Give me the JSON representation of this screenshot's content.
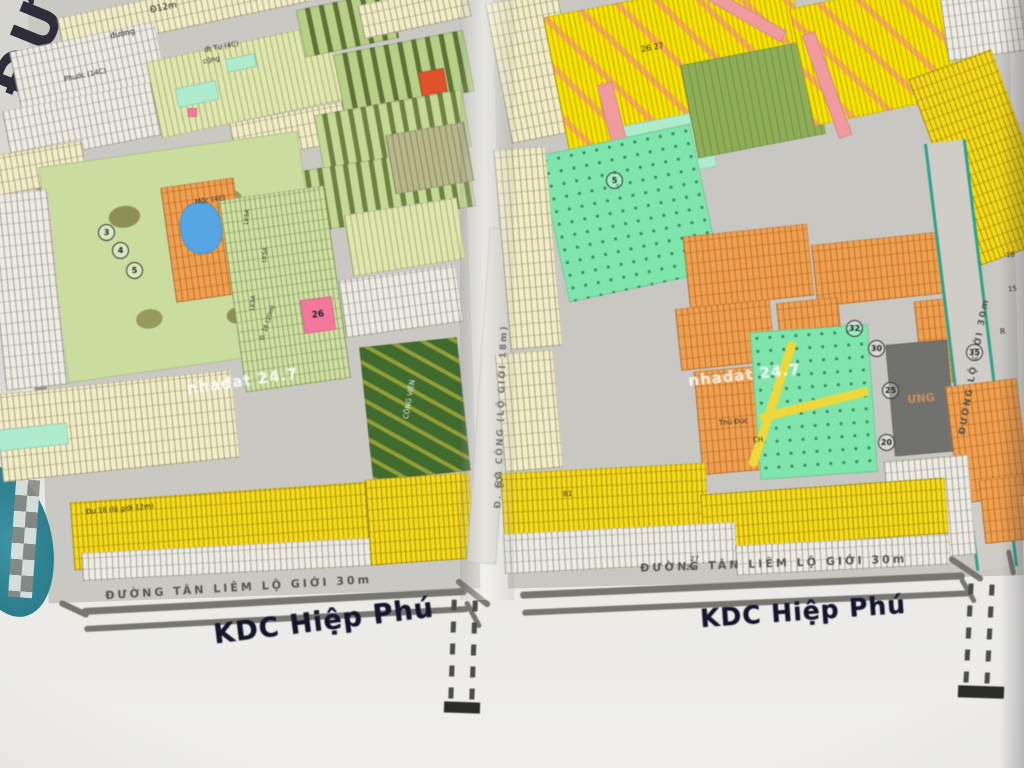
{
  "map": {
    "corner_text": "ĐƯ",
    "watermark_text": "nhadat 24.7",
    "watermarks": [
      {
        "x": 186,
        "y": 372,
        "rot": -8
      },
      {
        "x": 688,
        "y": 366,
        "rot": -6
      }
    ],
    "titles": [
      {
        "t": "KDC Hiệp Phú",
        "x": 213,
        "y": 606,
        "rot": -7,
        "s": 27
      },
      {
        "t": "KDC Hiệp Phú",
        "x": 700,
        "y": 597,
        "rot": -4,
        "s": 25
      }
    ],
    "road_names": [
      {
        "t": "ĐƯỜNG TÂN LIÊM LỘ GIỚI 30m",
        "x": 105,
        "y": 582,
        "rot": -3.5,
        "s": 11,
        "sp": 3
      },
      {
        "t": "ĐƯỜNG TÂN LIÊM LỘ GIỚI 30m",
        "x": 640,
        "y": 558,
        "rot": -2,
        "s": 11,
        "sp": 3
      },
      {
        "t": "Đ. GÒ CÔNG (LỘ GIỚI 18m)",
        "x": 352,
        "y": 412,
        "rot": -88,
        "s": 9,
        "sp": 2,
        "w": 300
      },
      {
        "t": "ĐƯỜNG LỘ GIỚI 30m",
        "x": 845,
        "y": 362,
        "rot": -80,
        "s": 9,
        "sp": 2,
        "w": 260
      }
    ],
    "labels": [
      {
        "t": "Đ12m",
        "x": 150,
        "y": 4,
        "rot": -12,
        "s": 9
      },
      {
        "t": "đường",
        "x": 110,
        "y": 30,
        "rot": -12,
        "s": 8
      },
      {
        "t": "đt Tư (4C)",
        "x": 204,
        "y": 44,
        "rot": -11,
        "s": 7
      },
      {
        "t": "cộng",
        "x": 203,
        "y": 57,
        "rot": -11,
        "s": 7
      },
      {
        "t": "Phước (14C)",
        "x": 64,
        "y": 72,
        "rot": -12,
        "s": 7
      },
      {
        "t": "Mộc (4E)",
        "x": 195,
        "y": 197,
        "rot": -8,
        "s": 7
      },
      {
        "t": "LK5A",
        "x": 240,
        "y": 214,
        "rot": -85,
        "s": 6
      },
      {
        "t": "LK5A",
        "x": 258,
        "y": 252,
        "rot": -85,
        "s": 6
      },
      {
        "t": "LK5A",
        "x": 246,
        "y": 300,
        "rot": -85,
        "s": 6
      },
      {
        "t": "Đ. 16 (20m)",
        "x": 250,
        "y": 320,
        "rot": -72,
        "s": 6
      },
      {
        "t": "Đư 18 (lộ giới 12m)",
        "x": 86,
        "y": 506,
        "rot": -5,
        "s": 7
      },
      {
        "t": "CÔNG VIÊN",
        "x": 390,
        "y": 396,
        "rot": -80,
        "s": 7,
        "cls": "w"
      },
      {
        "t": "26 27",
        "x": 641,
        "y": 44,
        "rot": -11,
        "s": 8
      },
      {
        "t": "Thủ Đức",
        "x": 719,
        "y": 419,
        "rot": -5,
        "s": 7
      },
      {
        "t": "CH",
        "x": 753,
        "y": 437,
        "rot": -5,
        "s": 7
      },
      {
        "t": "202",
        "x": 489,
        "y": 476,
        "rot": 80,
        "s": 9
      },
      {
        "t": "27",
        "x": 690,
        "y": 556,
        "rot": 0,
        "s": 7
      },
      {
        "t": "28",
        "x": 686,
        "y": 565,
        "rot": 0,
        "s": 7
      },
      {
        "t": "B1",
        "x": 563,
        "y": 491,
        "rot": -3,
        "s": 7
      },
      {
        "t": "R",
        "x": 1000,
        "y": 328,
        "rot": -7,
        "s": 8
      },
      {
        "t": "18",
        "x": 1006,
        "y": 252,
        "rot": -7,
        "s": 7
      },
      {
        "t": "15",
        "x": 1008,
        "y": 286,
        "rot": -7,
        "s": 7
      }
    ],
    "circles": [
      {
        "n": "3",
        "x": 98,
        "y": 224
      },
      {
        "n": "4",
        "x": 112,
        "y": 242
      },
      {
        "n": "5",
        "x": 126,
        "y": 262
      },
      {
        "n": "5",
        "x": 606,
        "y": 172
      },
      {
        "n": "32",
        "x": 846,
        "y": 320
      },
      {
        "n": "30",
        "x": 868,
        "y": 340
      },
      {
        "n": "25",
        "x": 882,
        "y": 382
      },
      {
        "n": "20",
        "x": 878,
        "y": 434
      },
      {
        "n": "35",
        "x": 966,
        "y": 344
      }
    ],
    "blocks": [
      {
        "n": "parcel-row",
        "cls": "cream-row",
        "x": 58,
        "y": -8,
        "w": 250,
        "h": 36,
        "rot": -12
      },
      {
        "n": "parcel-row",
        "cls": "white-row",
        "x": 14,
        "y": 36,
        "w": 148,
        "h": 62,
        "rot": -12
      },
      {
        "n": "parcel-row",
        "cls": "white-row",
        "x": 6,
        "y": 96,
        "w": 152,
        "h": 54,
        "rot": -11
      },
      {
        "n": "parcel-row",
        "cls": "cream-row",
        "x": -6,
        "y": 148,
        "w": 92,
        "h": 40,
        "rot": -10
      },
      {
        "n": "parcel-row",
        "cls": "green-pale",
        "x": 152,
        "y": 42,
        "w": 185,
        "h": 78,
        "rot": -12
      },
      {
        "n": "parcel-patch",
        "cls": "mint",
        "x": 176,
        "y": 84,
        "w": 42,
        "h": 20,
        "rot": -12
      },
      {
        "n": "parcel-patch",
        "cls": "mint",
        "x": 226,
        "y": 56,
        "w": 30,
        "h": 14,
        "rot": -12
      },
      {
        "n": "parcel-patch",
        "cls": "pink-block",
        "x": 188,
        "y": 108,
        "w": 9,
        "h": 9,
        "rot": 0
      },
      {
        "n": "parcel-row",
        "cls": "cream-row",
        "x": 232,
        "y": 112,
        "w": 115,
        "h": 40,
        "rot": -11
      },
      {
        "n": "city-block",
        "cls": "dark-city",
        "x": 300,
        "y": 0,
        "w": 95,
        "h": 48,
        "rot": -12
      },
      {
        "n": "city-block",
        "cls": "dark-city",
        "x": 338,
        "y": 42,
        "w": 132,
        "h": 62,
        "rot": -11
      },
      {
        "n": "city-block",
        "cls": "dark-city2",
        "x": 318,
        "y": 102,
        "w": 150,
        "h": 58,
        "rot": -10
      },
      {
        "n": "city-block",
        "cls": "dark-city2",
        "x": 300,
        "y": 158,
        "w": 172,
        "h": 62,
        "rot": -9
      },
      {
        "n": "building-marker",
        "cls": "red-marker",
        "x": 420,
        "y": 70,
        "w": 26,
        "h": 24,
        "rot": -10
      },
      {
        "n": "parcel-row",
        "cls": "cream-row",
        "x": 360,
        "y": -6,
        "w": 110,
        "h": 34,
        "rot": -12
      },
      {
        "n": "park-area",
        "cls": "park",
        "x": 52,
        "y": 148,
        "w": 262,
        "h": 218,
        "rot": -8
      },
      {
        "n": "parcel-row",
        "cls": "orange-row",
        "x": 168,
        "y": 182,
        "w": 74,
        "h": 116,
        "rot": -8
      },
      {
        "n": "pond",
        "cls": "blue-pond",
        "x": 180,
        "y": 202,
        "w": 42,
        "h": 52,
        "rot": -8
      },
      {
        "n": "parcel-row",
        "cls": "green-row",
        "x": 232,
        "y": 192,
        "w": 106,
        "h": 194,
        "rot": -8
      },
      {
        "n": "parcel-row",
        "cls": "white-row",
        "x": -4,
        "y": 192,
        "w": 62,
        "h": 196,
        "rot": -6
      },
      {
        "n": "parcel-row",
        "cls": "cream-row",
        "x": -2,
        "y": 382,
        "w": 238,
        "h": 88,
        "rot": -6
      },
      {
        "n": "parcel-patch",
        "cls": "mint",
        "x": -2,
        "y": 426,
        "w": 70,
        "h": 22,
        "rot": -6
      },
      {
        "n": "parcel-row",
        "cls": "yellow-row",
        "x": 72,
        "y": 492,
        "w": 296,
        "h": 68,
        "rot": -4
      },
      {
        "n": "parcel-row",
        "cls": "white-row",
        "x": 82,
        "y": 545,
        "w": 305,
        "h": 28,
        "rot": -3
      },
      {
        "n": "parcel-block",
        "cls": "pink-block",
        "x": 302,
        "y": 298,
        "w": 32,
        "h": 34,
        "rot": -8,
        "label": "26"
      },
      {
        "n": "parcel-row",
        "cls": "green-pale",
        "x": 348,
        "y": 206,
        "w": 114,
        "h": 62,
        "rot": -9
      },
      {
        "n": "parcel-row",
        "cls": "white-row",
        "x": 342,
        "y": 272,
        "w": 118,
        "h": 58,
        "rot": -8
      },
      {
        "n": "park-area",
        "cls": "forest",
        "x": 366,
        "y": 342,
        "w": 98,
        "h": 134,
        "rot": -6
      },
      {
        "n": "parcel-row",
        "cls": "yellow-row",
        "x": 368,
        "y": 476,
        "w": 104,
        "h": 86,
        "rot": -4
      },
      {
        "n": "parcel-row",
        "cls": "khaki-row",
        "x": 390,
        "y": 128,
        "w": 80,
        "h": 60,
        "rot": -10
      },
      {
        "n": "road-strip",
        "cls": "road-v",
        "x": 478,
        "y": 228,
        "w": 30,
        "h": 336,
        "rot": 4
      },
      {
        "n": "parcel-row",
        "cls": "cream-row",
        "x": 498,
        "y": -4,
        "w": 74,
        "h": 142,
        "rot": -11
      },
      {
        "n": "parcel-row",
        "cls": "yellow-dense",
        "x": 556,
        "y": -8,
        "w": 250,
        "h": 160,
        "rot": -11
      },
      {
        "n": "parcel-patch",
        "cls": "mint",
        "x": 618,
        "y": 118,
        "w": 95,
        "h": 58,
        "rot": -11
      },
      {
        "n": "city-block",
        "cls": "green-mid",
        "x": 688,
        "y": 52,
        "w": 130,
        "h": 95,
        "rot": -11
      },
      {
        "n": "road-strip",
        "cls": "salmon",
        "x": 608,
        "y": 82,
        "w": 16,
        "h": 95,
        "rot": -14
      },
      {
        "n": "road-strip",
        "cls": "salmon",
        "x": 700,
        "y": 8,
        "w": 90,
        "h": 13,
        "rot": 30
      },
      {
        "n": "parcel-row",
        "cls": "yellow-dense",
        "x": 800,
        "y": -8,
        "w": 150,
        "h": 120,
        "rot": -12
      },
      {
        "n": "road-strip",
        "cls": "salmon",
        "x": 820,
        "y": 30,
        "w": 14,
        "h": 110,
        "rot": -20
      },
      {
        "n": "parcel-row",
        "cls": "white-row",
        "x": 944,
        "y": -6,
        "w": 80,
        "h": 62,
        "rot": -8
      },
      {
        "n": "parcel-row",
        "cls": "yellow-row",
        "x": 940,
        "y": 58,
        "w": 88,
        "h": 200,
        "rot": -20
      },
      {
        "n": "park-area",
        "cls": "mint-bright",
        "x": 552,
        "y": 138,
        "w": 155,
        "h": 150,
        "rot": -12
      },
      {
        "n": "marker",
        "cls": "teal",
        "x": 512,
        "y": 204,
        "w": 20,
        "h": 20,
        "rot": 0
      },
      {
        "n": "parcel-row",
        "cls": "cream-row",
        "x": 502,
        "y": 148,
        "w": 52,
        "h": 200,
        "rot": -5
      },
      {
        "n": "parcel-row",
        "cls": "orange-row",
        "x": 686,
        "y": 230,
        "w": 125,
        "h": 72,
        "rot": -6
      },
      {
        "n": "parcel-row",
        "cls": "orange-row",
        "x": 814,
        "y": 238,
        "w": 132,
        "h": 62,
        "rot": -6
      },
      {
        "n": "parcel-row",
        "cls": "orange-row",
        "x": 678,
        "y": 304,
        "w": 95,
        "h": 62,
        "rot": -6
      },
      {
        "n": "parcel-row",
        "cls": "orange-row",
        "x": 698,
        "y": 368,
        "w": 76,
        "h": 104,
        "rot": -5
      },
      {
        "n": "parcel-row",
        "cls": "orange-row",
        "x": 778,
        "y": 300,
        "w": 62,
        "h": 40,
        "rot": -6
      },
      {
        "n": "parcel-row",
        "cls": "orange-row",
        "x": 918,
        "y": 298,
        "w": 62,
        "h": 84,
        "rot": -6
      },
      {
        "n": "park-area",
        "cls": "mint-bright",
        "x": 755,
        "y": 328,
        "w": 118,
        "h": 148,
        "rot": -4
      },
      {
        "n": "path",
        "cls": "yellow-path",
        "x": 768,
        "y": 338,
        "w": 9,
        "h": 132,
        "rot": 18
      },
      {
        "n": "path",
        "cls": "yellow-path",
        "x": 758,
        "y": 400,
        "w": 112,
        "h": 9,
        "rot": -14
      },
      {
        "n": "city-block",
        "cls": "darkgray",
        "x": 890,
        "y": 342,
        "w": 62,
        "h": 112,
        "rot": -5,
        "label": "ƯNG"
      },
      {
        "n": "road-strip",
        "cls": "road-diag",
        "x": 950,
        "y": 140,
        "w": 36,
        "h": 430,
        "rot": -7
      },
      {
        "n": "parcel-row",
        "cls": "orange-row",
        "x": 952,
        "y": 382,
        "w": 72,
        "h": 118,
        "rot": -7
      },
      {
        "n": "parcel-row",
        "cls": "white-row",
        "x": 888,
        "y": 458,
        "w": 84,
        "h": 100,
        "rot": -5
      },
      {
        "n": "parcel-row",
        "cls": "yellow-row",
        "x": 502,
        "y": 468,
        "w": 205,
        "h": 62,
        "rot": -3
      },
      {
        "n": "parcel-row",
        "cls": "yellow-row",
        "x": 702,
        "y": 486,
        "w": 245,
        "h": 56,
        "rot": -4
      },
      {
        "n": "parcel-row",
        "cls": "white-row",
        "x": 504,
        "y": 528,
        "w": 232,
        "h": 40,
        "rot": -3
      },
      {
        "n": "parcel-row",
        "cls": "white-row",
        "x": 736,
        "y": 540,
        "w": 214,
        "h": 30,
        "rot": -3
      },
      {
        "n": "parcel-row",
        "cls": "orange-row",
        "x": 982,
        "y": 478,
        "w": 42,
        "h": 64,
        "rot": -6
      },
      {
        "n": "parcel-row",
        "cls": "cream-row",
        "x": 500,
        "y": 352,
        "w": 58,
        "h": 118,
        "rot": -5
      }
    ],
    "lines": [
      {
        "x": 82,
        "y": 598,
        "w": 385,
        "h": 7,
        "rot": -3
      },
      {
        "x": 84,
        "y": 616,
        "w": 385,
        "h": 6,
        "rot": -3
      },
      {
        "x": 520,
        "y": 582,
        "w": 445,
        "h": 7,
        "rot": -2.5
      },
      {
        "x": 522,
        "y": 600,
        "w": 448,
        "h": 6,
        "rot": -2.5
      },
      {
        "x": 452,
        "y": 590,
        "w": 42,
        "h": 6,
        "rot": 38
      },
      {
        "x": 458,
        "y": 612,
        "w": 30,
        "h": 5,
        "rot": 62
      },
      {
        "x": 946,
        "y": 566,
        "w": 40,
        "h": 6,
        "rot": 34
      },
      {
        "x": 954,
        "y": 588,
        "w": 28,
        "h": 5,
        "rot": 60
      },
      {
        "x": 998,
        "y": 560,
        "w": 26,
        "h": 5,
        "rot": 78
      },
      {
        "x": 58,
        "y": 606,
        "w": 32,
        "h": 6,
        "rot": 25
      }
    ],
    "dashed_roads": [
      {
        "x": 450,
        "y": 600,
        "w": 26,
        "h": 102,
        "rot": 2
      },
      {
        "x": 966,
        "y": 584,
        "w": 26,
        "h": 100,
        "rot": 3
      }
    ],
    "end_bars": [
      {
        "x": 444,
        "y": 702,
        "w": 36,
        "h": 11,
        "rot": 2
      },
      {
        "x": 958,
        "y": 686,
        "w": 46,
        "h": 12,
        "rot": 2
      }
    ]
  }
}
